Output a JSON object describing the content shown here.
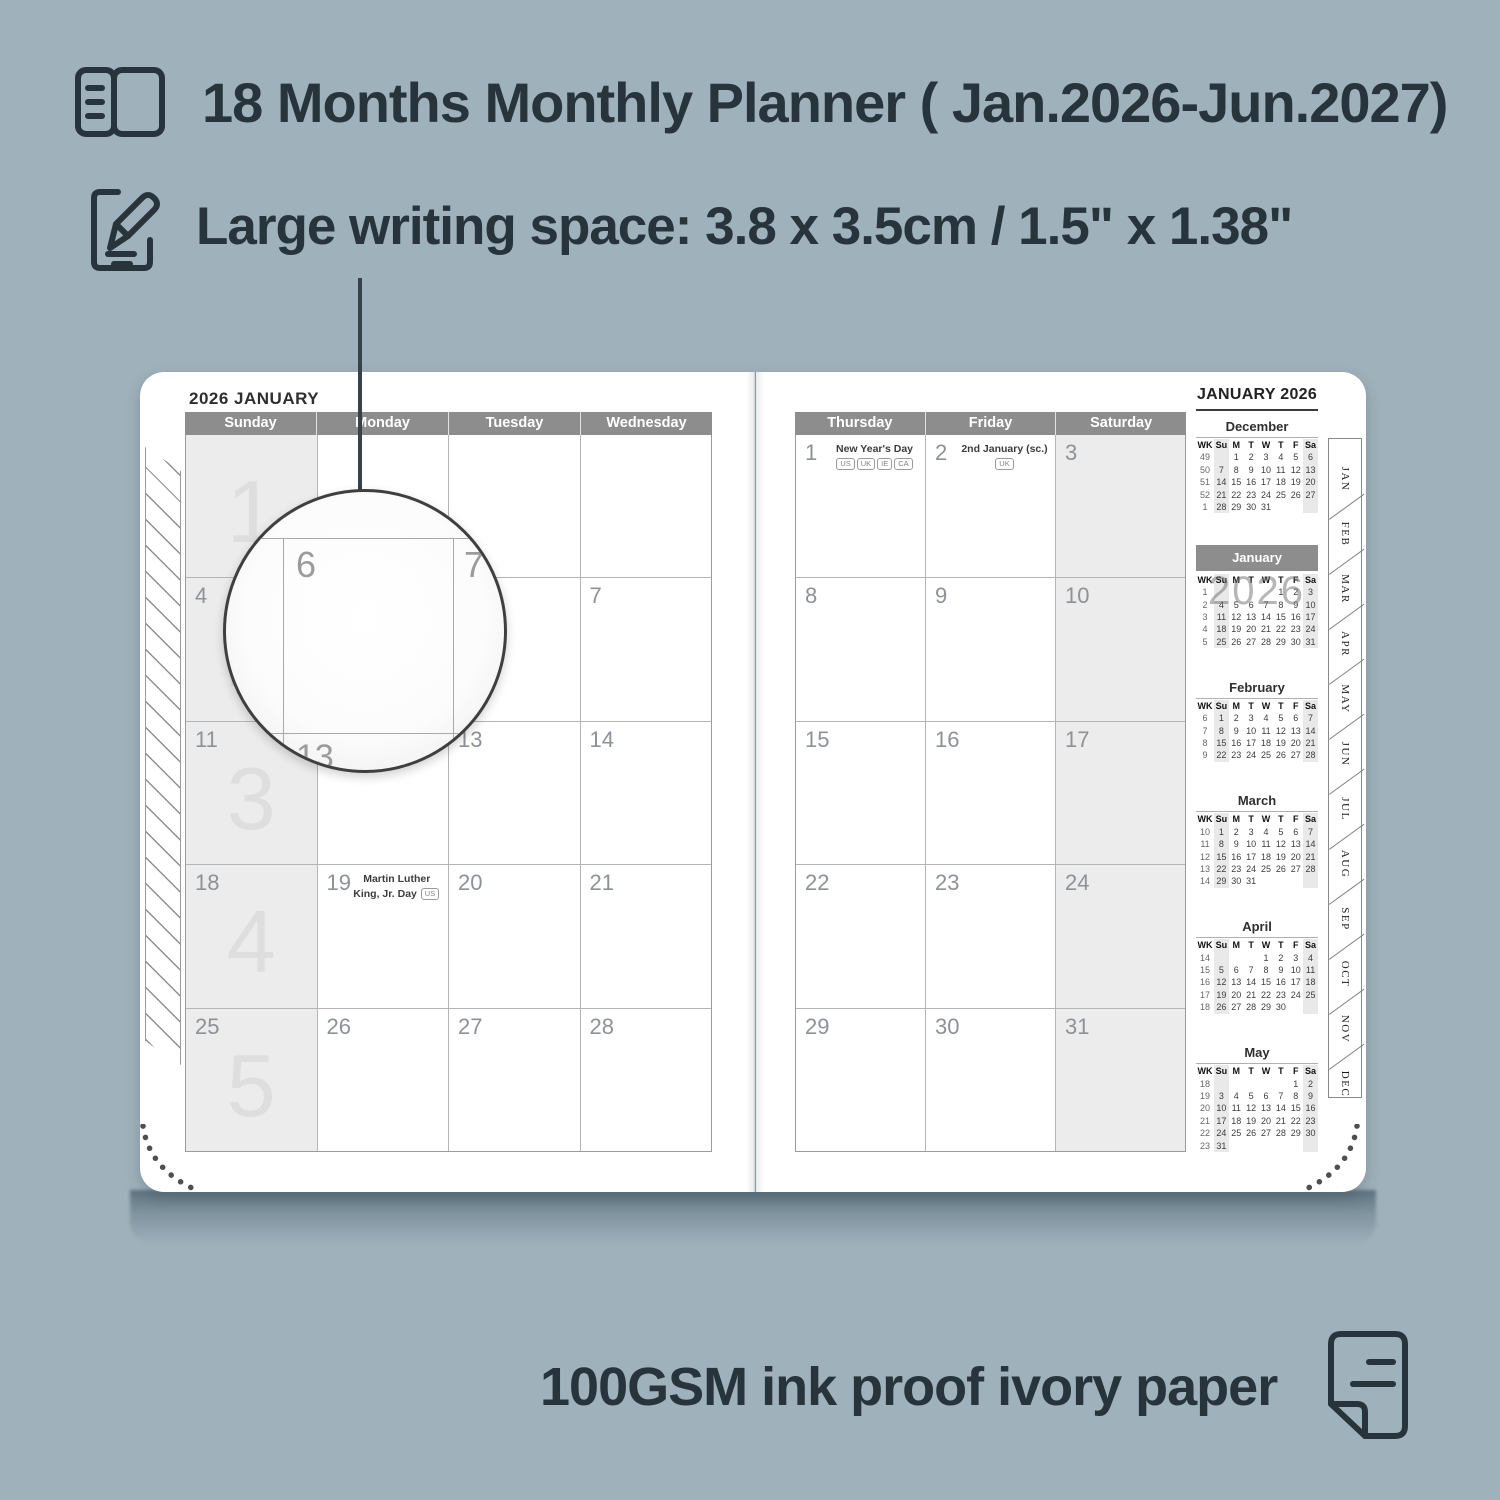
{
  "colors": {
    "background": "#9fb1bb",
    "ink": "#27343b",
    "header_gray": "#8d8d8d",
    "shaded_cell": "#ececec"
  },
  "features": {
    "planner": {
      "icon": "book-icon",
      "text": "18 Months Monthly Planner ( Jan.2026-Jun.2027)"
    },
    "writing": {
      "icon": "pencil-edit-icon",
      "text": "Large writing space: 3.8 x 3.5cm / 1.5\" x 1.38\""
    },
    "paper": {
      "icon": "paper-sheet-icon",
      "text": "100GSM ink proof ivory paper"
    }
  },
  "planner": {
    "left_page": {
      "title": "2026 JANUARY",
      "day_headers": [
        "Sunday",
        "Monday",
        "Tuesday",
        "Wednesday"
      ],
      "shaded_column": 0,
      "rows": [
        {
          "watermark": "1",
          "cells": [
            {
              "d": ""
            },
            {
              "d": ""
            },
            {
              "d": ""
            },
            {
              "d": ""
            }
          ]
        },
        {
          "watermark": "2",
          "cells": [
            {
              "d": "4"
            },
            {
              "d": "5"
            },
            {
              "d": "6"
            },
            {
              "d": "7"
            }
          ]
        },
        {
          "watermark": "3",
          "cells": [
            {
              "d": "11"
            },
            {
              "d": "12"
            },
            {
              "d": "13"
            },
            {
              "d": "14"
            }
          ]
        },
        {
          "watermark": "4",
          "cells": [
            {
              "d": "18"
            },
            {
              "d": "19",
              "note": "Martin Luther King, Jr. Day",
              "badges": [
                "US"
              ]
            },
            {
              "d": "20"
            },
            {
              "d": "21"
            }
          ]
        },
        {
          "watermark": "5",
          "cells": [
            {
              "d": "25"
            },
            {
              "d": "26"
            },
            {
              "d": "27"
            },
            {
              "d": "28"
            }
          ]
        }
      ]
    },
    "right_page": {
      "day_headers": [
        "Thursday",
        "Friday",
        "Saturday"
      ],
      "shaded_column": 2,
      "rows": [
        {
          "cells": [
            {
              "d": "1",
              "note": "New Year's Day",
              "badges": [
                "US",
                "UK",
                "IE",
                "CA"
              ]
            },
            {
              "d": "2",
              "note": "2nd January (sc.)",
              "badges": [
                "UK"
              ]
            },
            {
              "d": "3"
            }
          ]
        },
        {
          "cells": [
            {
              "d": "8"
            },
            {
              "d": "9"
            },
            {
              "d": "10"
            }
          ]
        },
        {
          "cells": [
            {
              "d": "15"
            },
            {
              "d": "16"
            },
            {
              "d": "17"
            }
          ]
        },
        {
          "cells": [
            {
              "d": "22"
            },
            {
              "d": "23"
            },
            {
              "d": "24"
            }
          ]
        },
        {
          "cells": [
            {
              "d": "29"
            },
            {
              "d": "30"
            },
            {
              "d": "31"
            }
          ]
        }
      ]
    },
    "sidebar": {
      "title": "JANUARY 2026",
      "mini_header": [
        "WK",
        "Su",
        "M",
        "T",
        "W",
        "T",
        "F",
        "Sa"
      ],
      "months": [
        {
          "name": "December",
          "weeks": [
            [
              49,
              "",
              1,
              2,
              3,
              4,
              5,
              6
            ],
            [
              50,
              7,
              8,
              9,
              10,
              11,
              12,
              13
            ],
            [
              51,
              14,
              15,
              16,
              17,
              18,
              19,
              20
            ],
            [
              52,
              21,
              22,
              23,
              24,
              25,
              26,
              27
            ],
            [
              1,
              28,
              29,
              30,
              31,
              "",
              "",
              ""
            ]
          ]
        },
        {
          "name": "January",
          "highlight": true,
          "watermark": "2026",
          "weeks": [
            [
              1,
              "",
              "",
              "",
              "",
              1,
              2,
              3
            ],
            [
              2,
              4,
              5,
              6,
              7,
              8,
              9,
              10
            ],
            [
              3,
              11,
              12,
              13,
              14,
              15,
              16,
              17
            ],
            [
              4,
              18,
              19,
              20,
              21,
              22,
              23,
              24
            ],
            [
              5,
              25,
              26,
              27,
              28,
              29,
              30,
              31
            ]
          ]
        },
        {
          "name": "February",
          "weeks": [
            [
              6,
              1,
              2,
              3,
              4,
              5,
              6,
              7
            ],
            [
              7,
              8,
              9,
              10,
              11,
              12,
              13,
              14
            ],
            [
              8,
              15,
              16,
              17,
              18,
              19,
              20,
              21
            ],
            [
              9,
              22,
              23,
              24,
              25,
              26,
              27,
              28
            ]
          ]
        },
        {
          "name": "March",
          "weeks": [
            [
              10,
              1,
              2,
              3,
              4,
              5,
              6,
              7
            ],
            [
              11,
              8,
              9,
              10,
              11,
              12,
              13,
              14
            ],
            [
              12,
              15,
              16,
              17,
              18,
              19,
              20,
              21
            ],
            [
              13,
              22,
              23,
              24,
              25,
              26,
              27,
              28
            ],
            [
              14,
              29,
              30,
              31,
              "",
              "",
              "",
              ""
            ]
          ]
        },
        {
          "name": "April",
          "weeks": [
            [
              14,
              "",
              "",
              "",
              1,
              2,
              3,
              4
            ],
            [
              15,
              5,
              6,
              7,
              8,
              9,
              10,
              11
            ],
            [
              16,
              12,
              13,
              14,
              15,
              16,
              17,
              18
            ],
            [
              17,
              19,
              20,
              21,
              22,
              23,
              24,
              25
            ],
            [
              18,
              26,
              27,
              28,
              29,
              30,
              "",
              ""
            ]
          ]
        },
        {
          "name": "May",
          "weeks": [
            [
              18,
              "",
              "",
              "",
              "",
              "",
              1,
              2
            ],
            [
              19,
              3,
              4,
              5,
              6,
              7,
              8,
              9
            ],
            [
              20,
              10,
              11,
              12,
              13,
              14,
              15,
              16
            ],
            [
              21,
              17,
              18,
              19,
              20,
              21,
              22,
              23
            ],
            [
              22,
              24,
              25,
              26,
              27,
              28,
              29,
              30
            ],
            [
              23,
              31,
              "",
              "",
              "",
              "",
              "",
              ""
            ]
          ]
        }
      ]
    },
    "tabs": [
      "JAN",
      "FEB",
      "MAR",
      "APR",
      "MAY",
      "JUN",
      "JUL",
      "AUG",
      "SEP",
      "OCT",
      "NOV",
      "DEC"
    ],
    "magnifier": {
      "zoom_cell": "6",
      "adjacent_cell": "7",
      "below_cell": "13"
    }
  }
}
